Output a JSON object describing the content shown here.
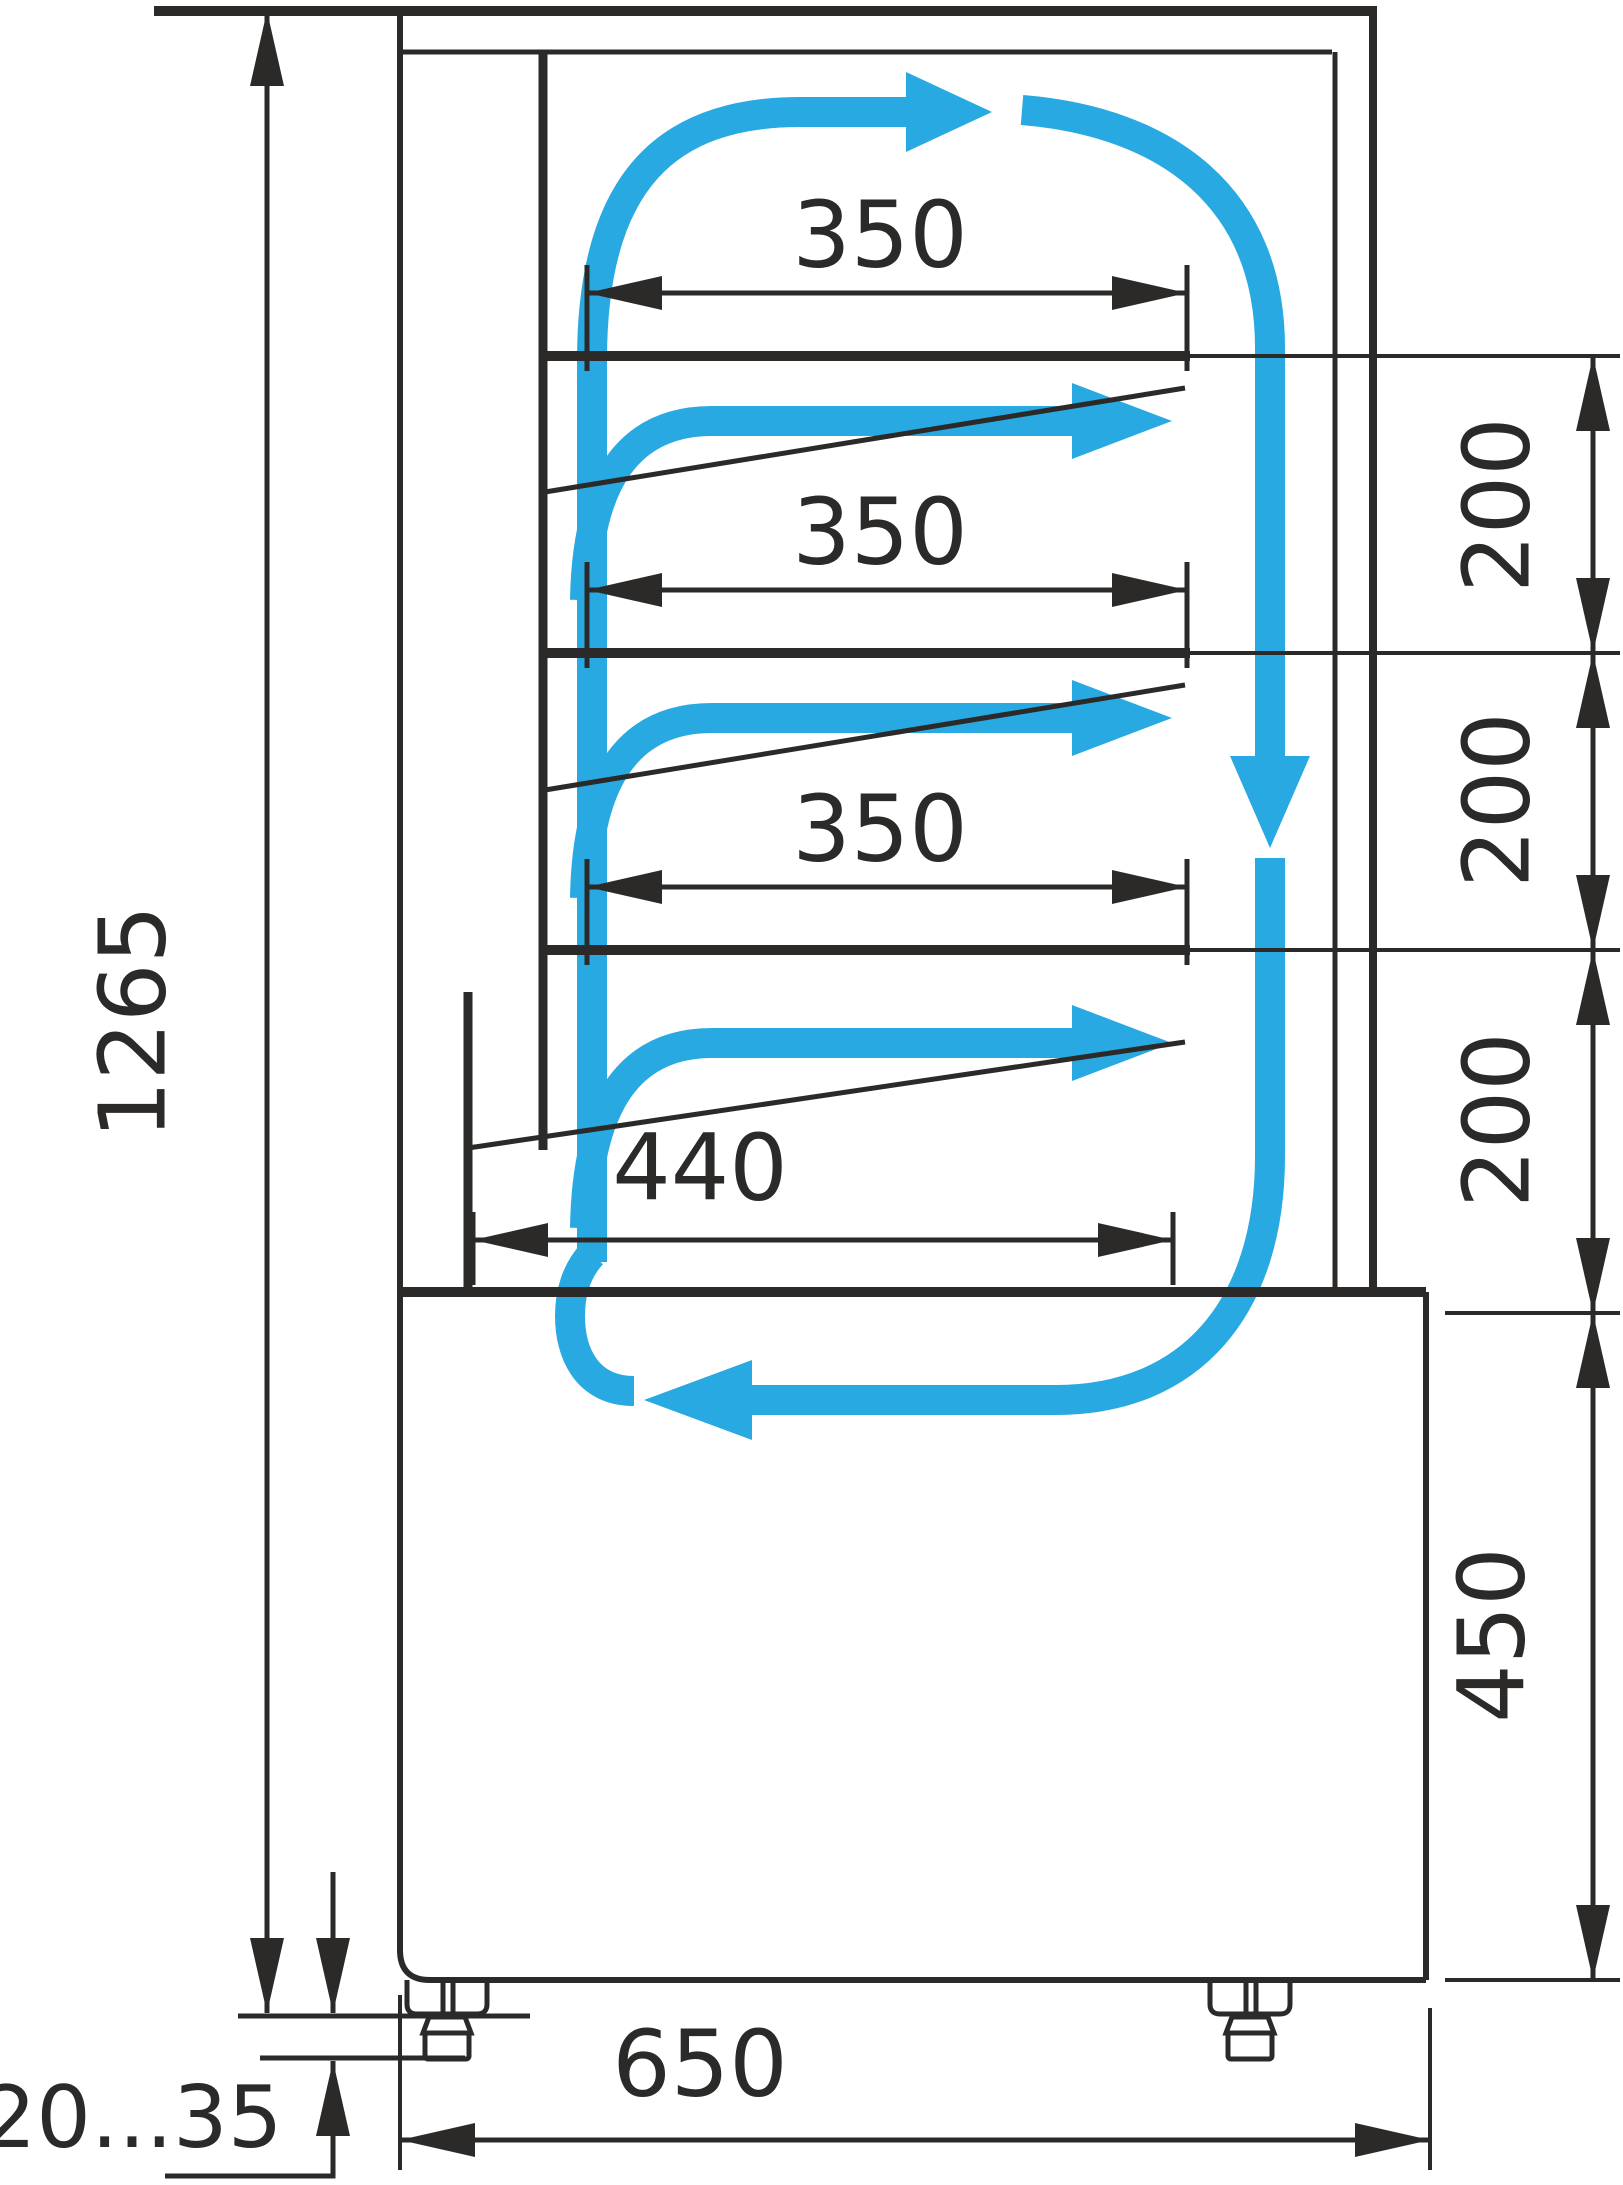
{
  "diagram": {
    "type": "technical-dimension-drawing",
    "subject": "refrigerated-display-case-side-section",
    "units": "mm",
    "colors": {
      "line": "#2B2A29",
      "airflow": "#29A9E1",
      "background": "#FFFFFF"
    },
    "dimensions": {
      "overall_height": {
        "label": "1265"
      },
      "shelf_depths": [
        {
          "label": "350"
        },
        {
          "label": "350"
        },
        {
          "label": "350"
        }
      ],
      "bottom_shelf_depth": {
        "label": "440"
      },
      "shelf_spacings": [
        {
          "label": "200"
        },
        {
          "label": "200"
        },
        {
          "label": "200"
        }
      ],
      "base_height": {
        "label": "450"
      },
      "overall_depth": {
        "label": "650"
      },
      "foot_adjustment_range": {
        "label": "20...35"
      }
    },
    "airflow": {
      "pattern": "clockwise-circulation",
      "arrows": [
        "top-supply-arrow",
        "front-down-arrow",
        "shelf-branch-arrow-1",
        "shelf-branch-arrow-2",
        "shelf-branch-arrow-3",
        "bottom-return-arrow"
      ]
    }
  }
}
